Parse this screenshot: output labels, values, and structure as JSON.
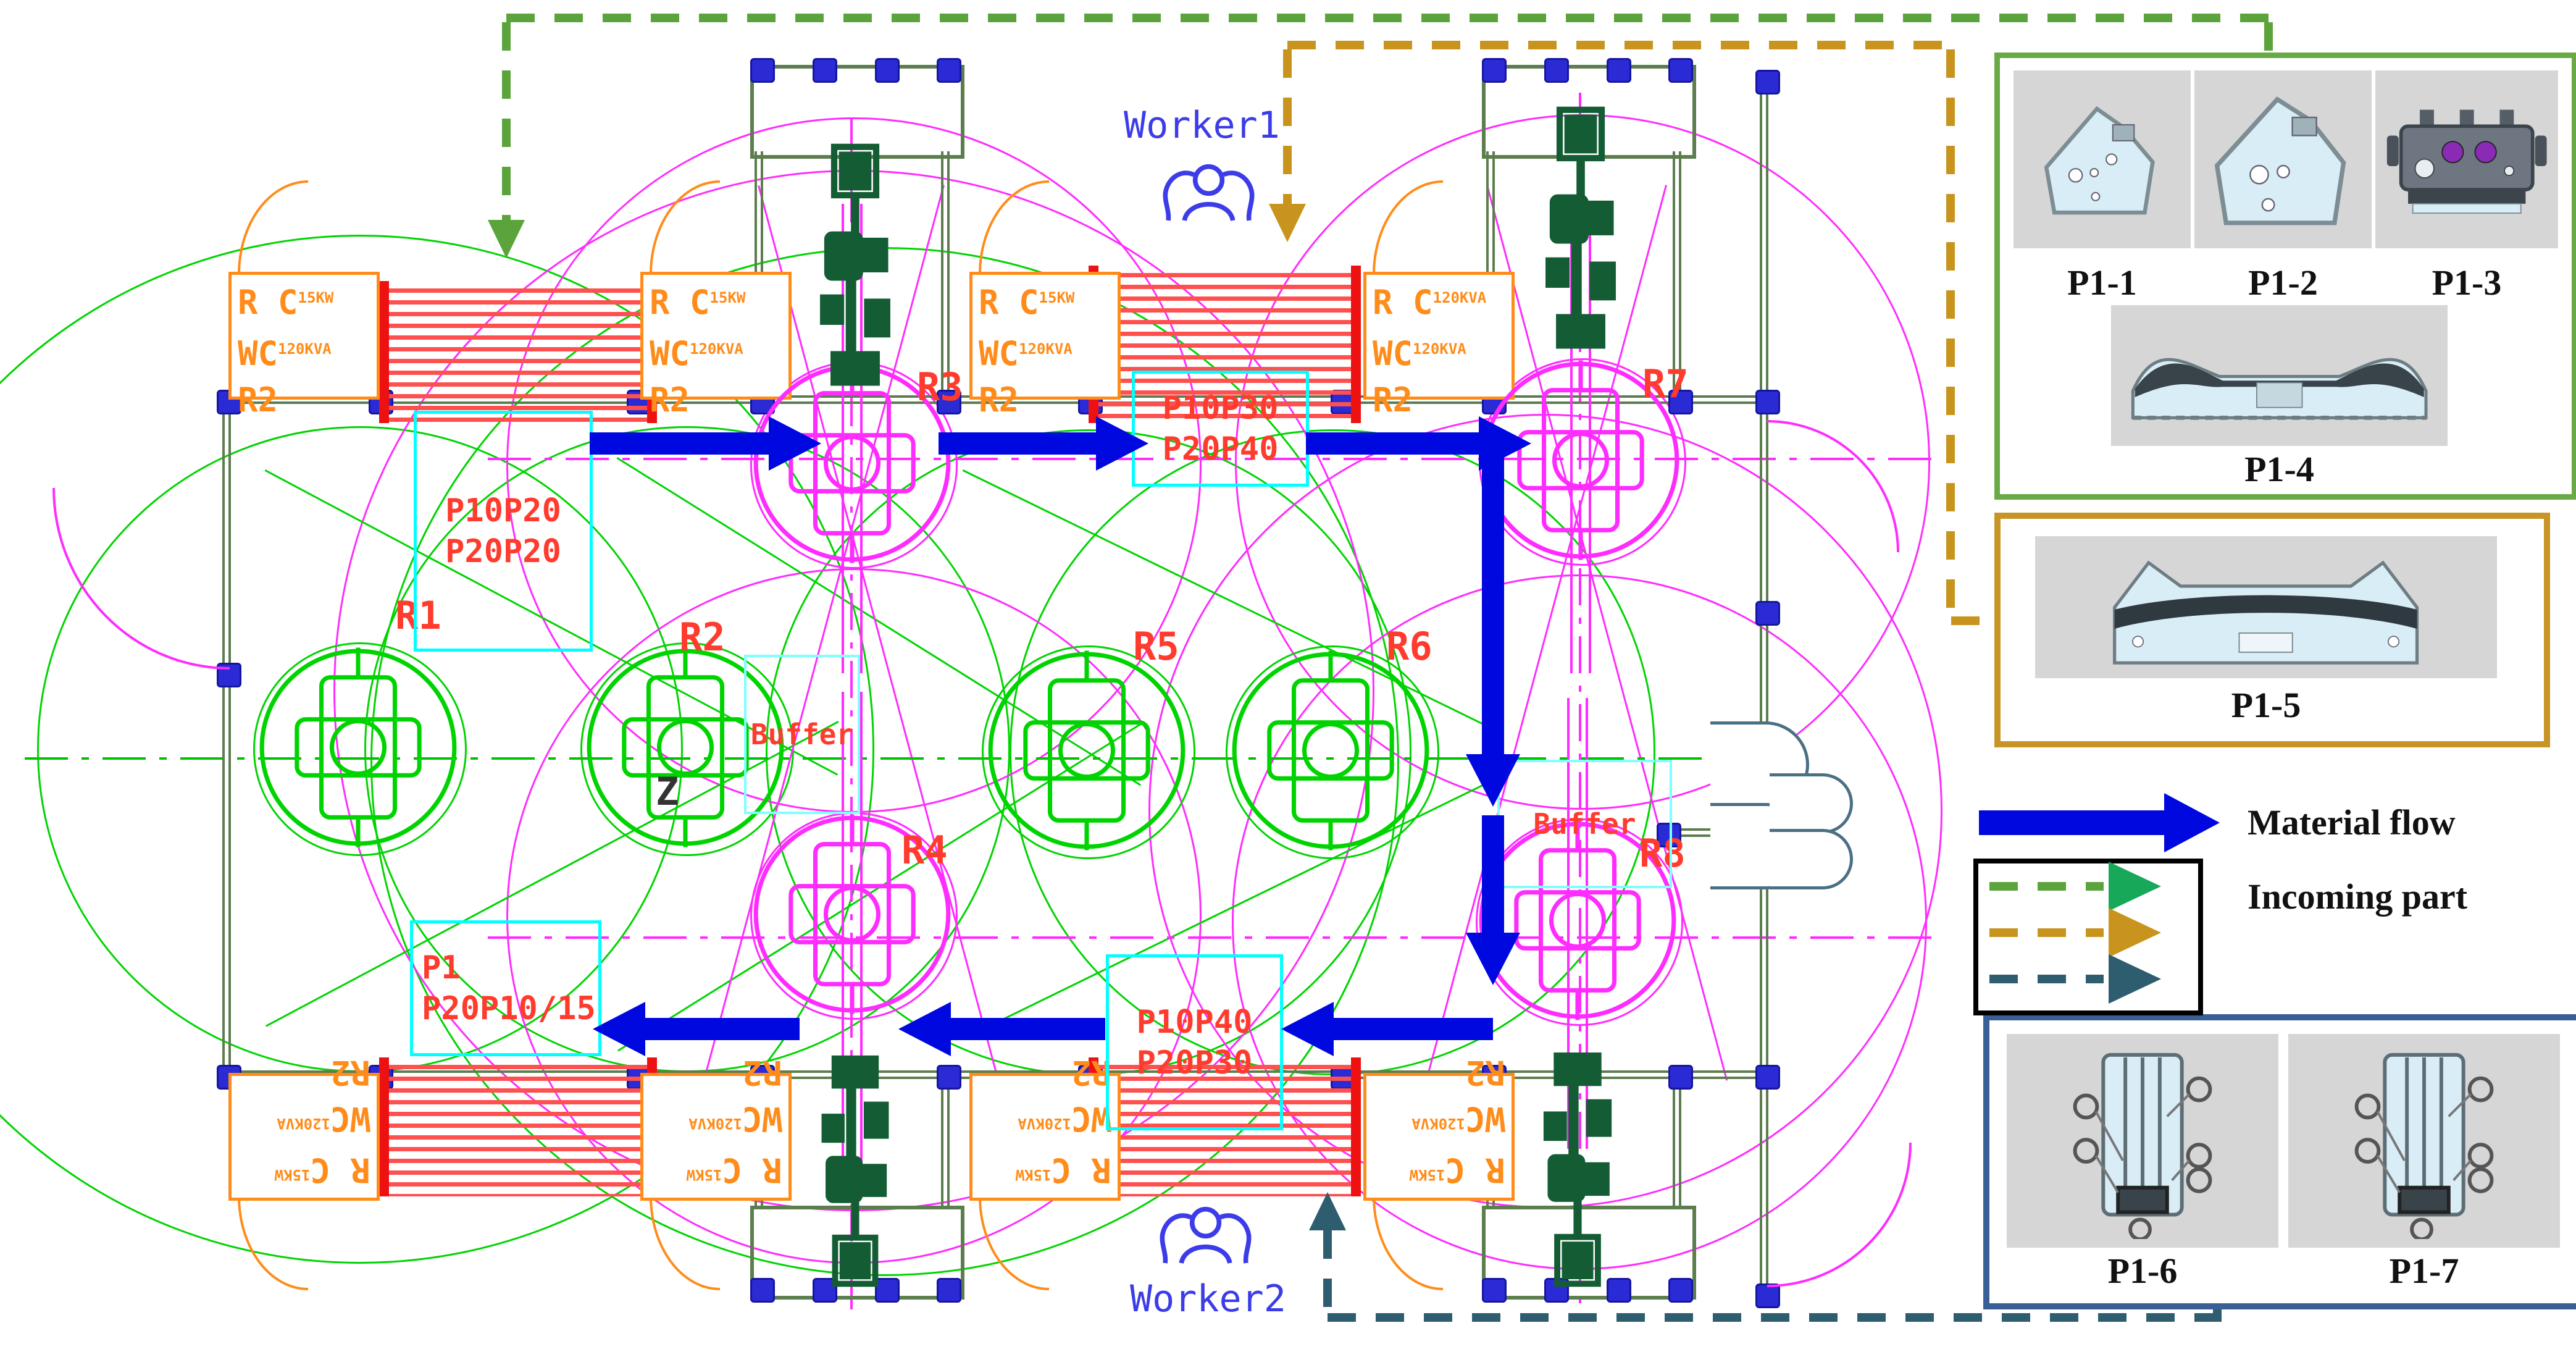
{
  "legend": {
    "material_flow": "Material flow",
    "incoming_part": "Incoming part"
  },
  "panels": {
    "group1": {
      "cap1": "P1-1",
      "cap2": "P1-2",
      "cap3": "P1-3",
      "cap4": "P1-4"
    },
    "group2": {
      "cap": "P1-5"
    },
    "group3": {
      "cap1": "P1-6",
      "cap2": "P1-7"
    }
  },
  "workers": {
    "w1": "Worker1",
    "w2": "Worker2"
  },
  "robots": {
    "r1": "R1",
    "r2": "R2",
    "r3": "R3",
    "r4": "R4",
    "r5": "R5",
    "r6": "R6",
    "r7": "R7",
    "r8": "R8"
  },
  "stations": {
    "rc": "R C",
    "rc_rating": "15KW",
    "wc": "WC",
    "wc_rating": "120KVA",
    "cell": "R2"
  },
  "flow_boxes": {
    "a1": "P10P20",
    "a2": "P20P20",
    "b1": "P10P30",
    "b2": "P20P40",
    "c1": "P10P40",
    "c2": "P20P30",
    "d1": "P1",
    "d2": "P20P10/15"
  },
  "buffers": {
    "left": "Buffer",
    "right": "Buffer"
  },
  "annotations": {
    "z": "Z"
  },
  "colors": {
    "material_flow": "#0008e0",
    "incoming_green": "#5ba43c",
    "incoming_gold": "#c8941d",
    "incoming_teal": "#2f5d70",
    "robot_green": "#00d400",
    "robot_magenta": "#ff2cff",
    "wall_olive": "#5c7d4e",
    "cabinet_orange": "#ff8c1a",
    "label_red": "#ff3b2e",
    "marker_cyan": "#00ffff"
  }
}
